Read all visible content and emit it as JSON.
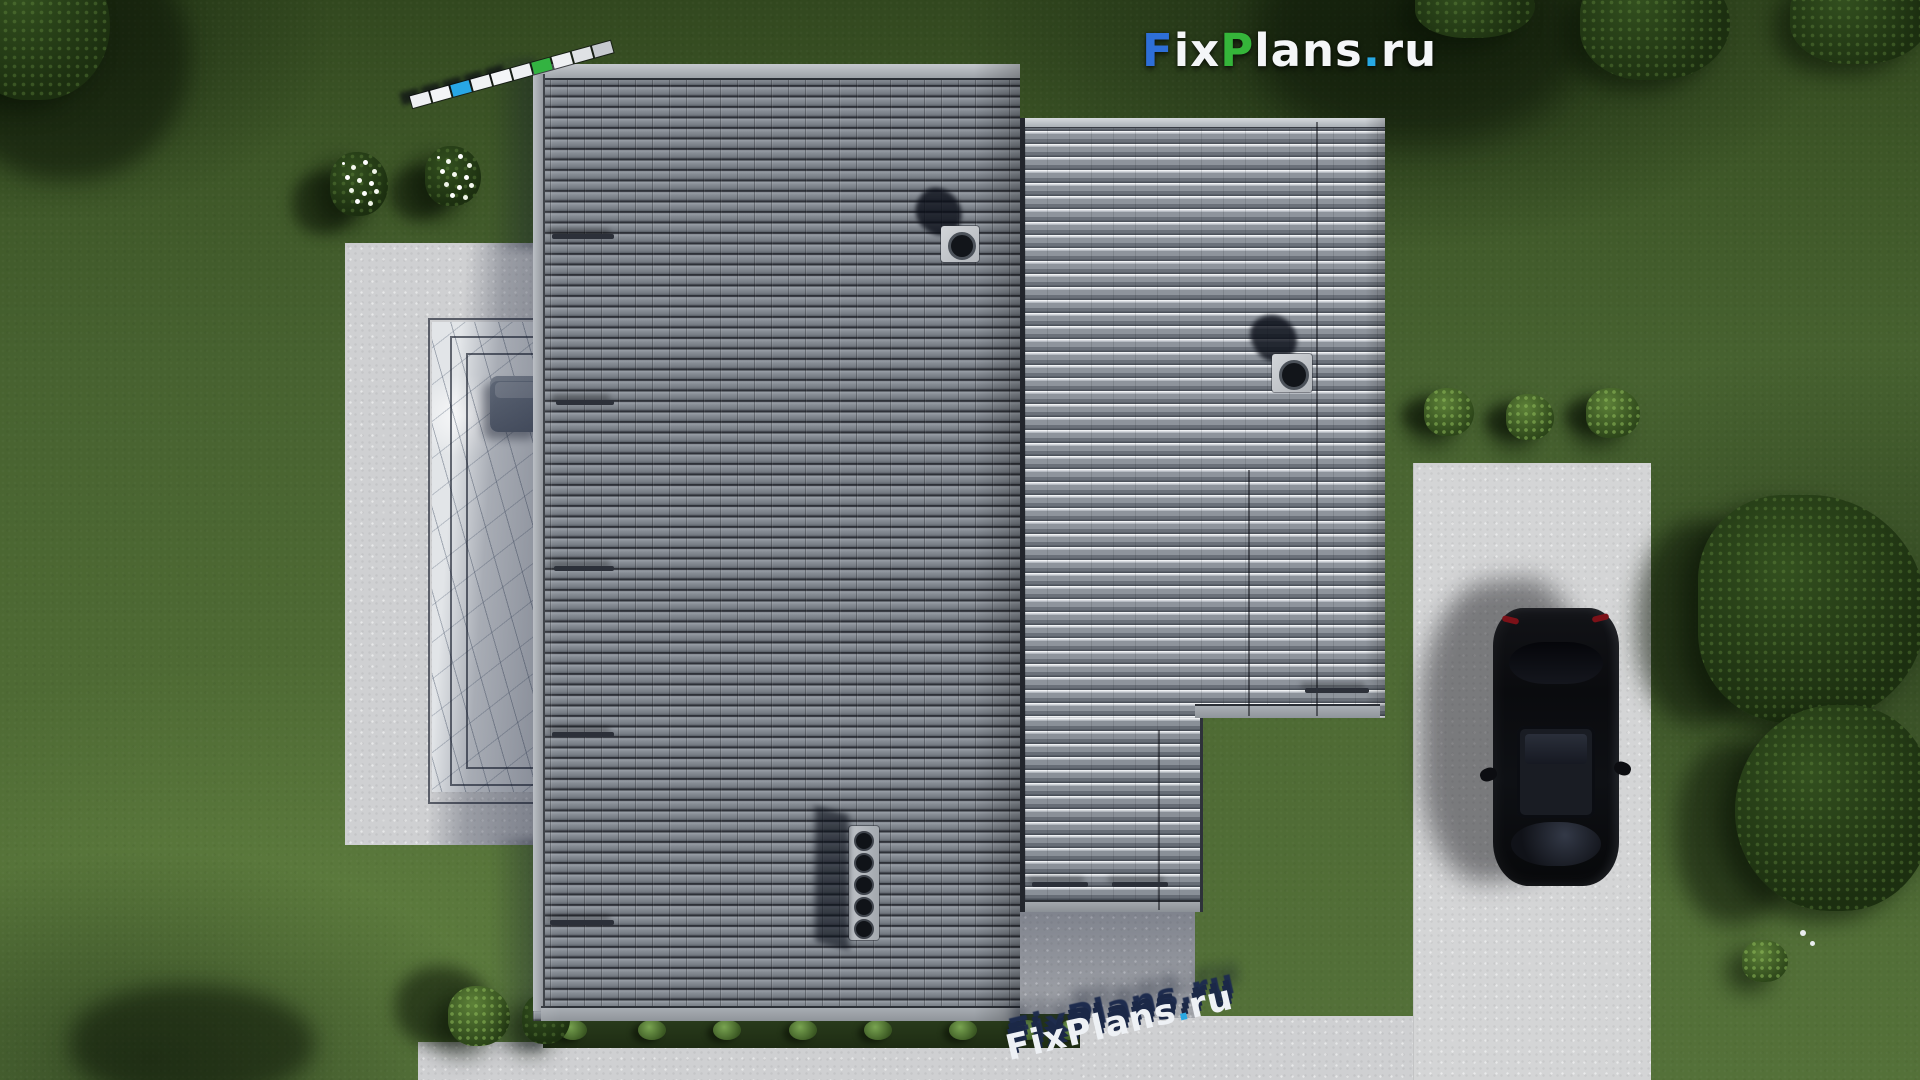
{
  "logo": {
    "parts": [
      {
        "text": "F",
        "color": "#2e6fd8"
      },
      {
        "text": "ix",
        "color": "#f4f6f8"
      },
      {
        "text": "P",
        "color": "#35b53a"
      },
      {
        "text": "lans",
        "color": "#f4f6f8"
      },
      {
        "text": ".",
        "color": "#27a9e4"
      },
      {
        "text": "ru",
        "color": "#f4f6f8"
      }
    ]
  },
  "watermark": {
    "part1": "FixPlans",
    "dot": ".",
    "part2": "ru",
    "dot_color": "#29a8e2"
  },
  "scale_bar": {
    "segments": [
      "#eef0f3",
      "#f3f5f7",
      "#28a7e6",
      "#f0f2f4",
      "#f4f6f8",
      "#eef0f3",
      "#33b341",
      "#eef0f3",
      "#dfe2e5",
      "#c6cacf"
    ]
  },
  "colors": {
    "paving": "#cfd0d2",
    "driveway": "#d4d5d6",
    "roof_tile": "#848a91",
    "roof_ribbed": "#9aa0a7",
    "marble": "#e2e5e8",
    "grass_base": "#4a652f",
    "car_body": "#0b0c0e",
    "shadow_navy": "#141c33"
  }
}
